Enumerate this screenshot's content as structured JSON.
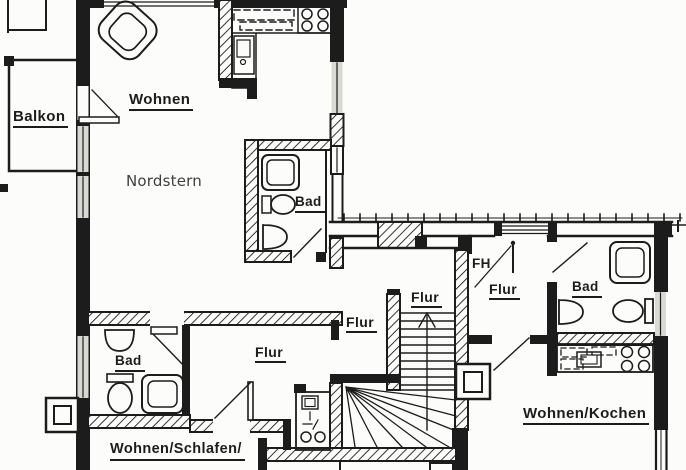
{
  "plan": {
    "type": "scanned architectural floor plan, upper storey with three units and central staircase",
    "colors": {
      "ink": "#1c1c1c",
      "paper": "#fcfcfa",
      "glass": "#d9d9d4",
      "digital_text": "#3f3f3f"
    },
    "labels": {
      "balkon": "Balkon",
      "wohnen": "Wohnen",
      "nordstern": "Nordstern",
      "bad_top": "Bad",
      "bad_right": "Bad",
      "bad_lower": "Bad",
      "fh": "FH",
      "flur_wing": "Flur",
      "flur_landing": "Flur",
      "flur_strip": "Flur",
      "flur_lower": "Flur",
      "wohnen_kochen": "Wohnen/Kochen",
      "wohnen_schlafen": "Wohnen/Schlafen/"
    },
    "symbols": [
      "armchair",
      "stove-4-burner",
      "kitchen-sink",
      "upper-cabinets-dashed",
      "shower",
      "toilet",
      "washbasin",
      "staircase-up-arrow",
      "winder-stairs",
      "door-swing",
      "window",
      "chimney",
      "kitchenette-2-burner"
    ]
  }
}
